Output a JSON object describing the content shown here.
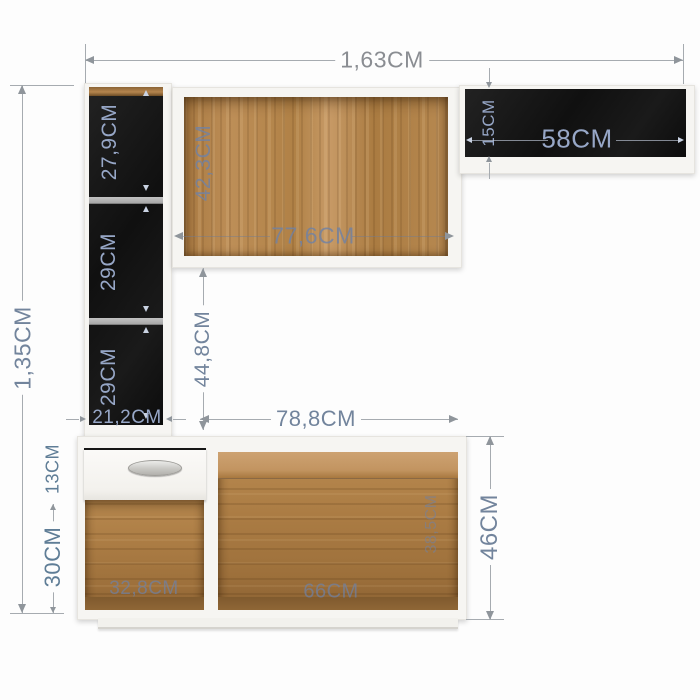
{
  "furniture_diagram": {
    "overall": {
      "width": "1,63CM",
      "height": "1,35CM"
    },
    "left_tower": {
      "top_section_height": "27,9CM",
      "middle_section_height": "29CM",
      "bottom_section_height": "29CM",
      "width": "21,2CM"
    },
    "upper_center_cabinet": {
      "interior_height": "42,3CM",
      "interior_width": "77,6CM"
    },
    "upper_right_shelf": {
      "height": "15CM",
      "width": "58CM"
    },
    "middle_gap": {
      "height": "44,8CM"
    },
    "base_cabinet": {
      "top_width": "78,8CM",
      "drawer_height": "13CM",
      "left_opening_height": "30CM",
      "left_opening_width": "32,8CM",
      "right_opening_width": "66CM",
      "right_opening_depth": "38,5CM",
      "height": "46CM"
    },
    "colors": {
      "dimension_text": "#72849c",
      "dimension_text_on_black": "#97a7c7",
      "dimension_line": "#a6abb0",
      "cabinet_interior_black": "#141414",
      "wood_mid": "#b08146",
      "panel_white": "#f6f5f2"
    }
  }
}
